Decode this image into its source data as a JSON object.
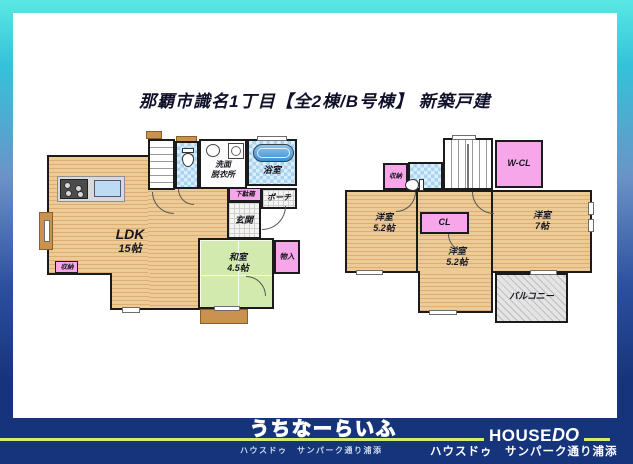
{
  "title": "那覇市識名1丁目【全2棟/B号棟】 新築戸建",
  "floor1": {
    "ldk": {
      "name": "LDK",
      "size": "15帖"
    },
    "washitsu": {
      "name": "和室",
      "size": "4.5帖"
    },
    "bath": "浴室",
    "washroom": {
      "line1": "洗面",
      "line2": "脱衣所"
    },
    "entrance": "玄関",
    "porch": "ポーチ",
    "shoe_box": "下駄箱",
    "storage": "収納",
    "closet": "物入"
  },
  "floor2": {
    "room_left": {
      "name": "洋室",
      "size": "5.2帖"
    },
    "room_right": {
      "name": "洋室",
      "size": "7帖"
    },
    "room_center": {
      "name": "洋室",
      "size": "5.2帖"
    },
    "balcony": "バルコニー",
    "walk_in_closet": "W-CL",
    "closet": "CL",
    "storage": "収納"
  },
  "footer": {
    "brand_name": "うちなーらいふ",
    "brand_subtitle": "ハウスドゥ　サンパーク通り浦添",
    "logo_part1": "HOUSE",
    "logo_part2": "DO",
    "store_name": "ハウスドゥ　サンパーク通り浦添"
  },
  "colors": {
    "frame_top": "#5ae8e4",
    "frame_bottom": "#16347b",
    "accent_line": "#d9e96f",
    "wood_floor": "#e7c28d",
    "tatami": "#d2eaae",
    "tile_blue": "#a9d4f0",
    "closet_pink": "#f7a6e9"
  }
}
